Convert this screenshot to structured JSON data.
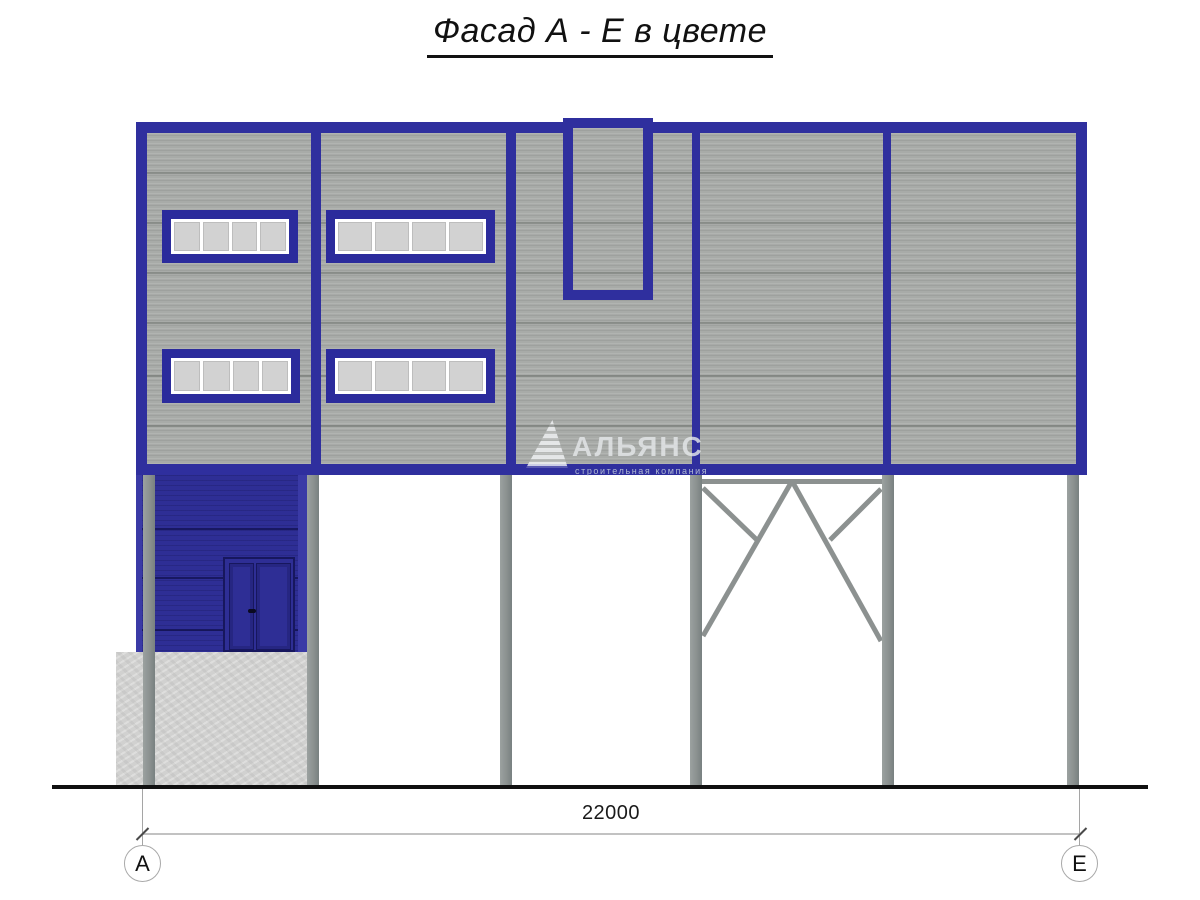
{
  "title": "Фасад А - Е в цвете",
  "watermark": {
    "name": "АЛЬЯНС",
    "subtitle": "строительная компания"
  },
  "dimension": {
    "total_width_mm": "22000"
  },
  "axes": {
    "left": "А",
    "right": "Е"
  },
  "colors": {
    "trim_blue": "#2f2f9e",
    "annex_blue": "#2e2e95",
    "facade_gray": "#a8aba8",
    "column_gray": "#8c9190",
    "concrete_gray": "#d1d1d0",
    "window_pane": "#d2d2d2",
    "ground_black": "#101010"
  }
}
